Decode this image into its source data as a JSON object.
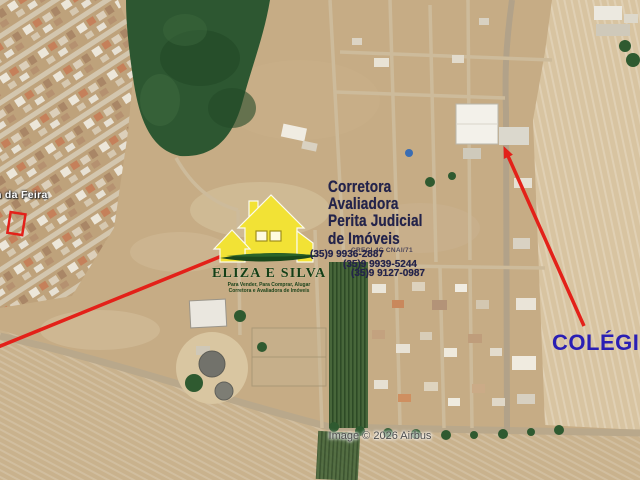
{
  "map": {
    "place_label": "n da Feira",
    "annotation_label": "COLÉGIO",
    "attribution": "Image © 2026 Airbus"
  },
  "advert": {
    "title_lines": [
      "Corretora",
      "Avaliadora",
      "Perita Judicial",
      "de Imóveis"
    ],
    "creci_line": "CRECI 4C CNAI/71",
    "phones": [
      "(35)9 9936-2887",
      "(35)9 9939-5244",
      "(35)9 9127-0987"
    ]
  },
  "logo": {
    "name": "ELIZA E SILVA",
    "tagline1": "Para Vender, Para Comprar, Alugar",
    "tagline2": "Corretora e Avaliadora de Imóveis"
  },
  "colors": {
    "annotation_red": "#e32119",
    "colegio_blue": "#2a1fb4",
    "advert_navy": "#23234a",
    "logo_yellow": "#f2e235",
    "logo_green": "#1b481b",
    "forest_green": "#2d5731"
  }
}
